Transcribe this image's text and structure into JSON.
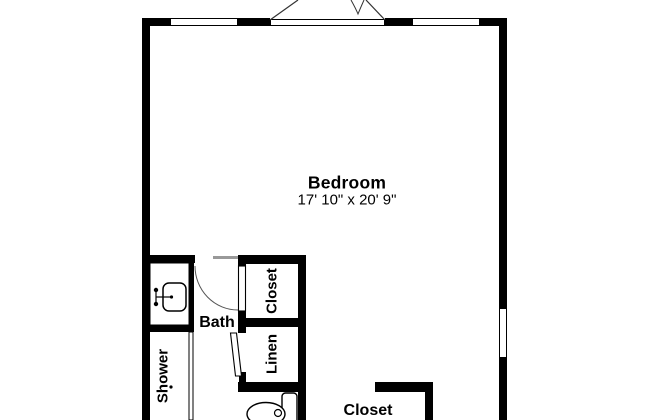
{
  "plan": {
    "type": "floor-plan",
    "rooms": {
      "bedroom": {
        "label": "Bedroom",
        "dimensions": "17' 10\" x 20' 9\""
      },
      "bath": {
        "label": "Bath"
      },
      "shower": {
        "label": "Shower"
      },
      "closet_upper": {
        "label": "Closet"
      },
      "linen": {
        "label": "Linen"
      },
      "closet_lower": {
        "label": "Closet"
      }
    },
    "fixtures": [
      "french-doors",
      "window",
      "window",
      "window-right",
      "vanity-sink",
      "faucet",
      "shower-enclosure",
      "toilet",
      "bath-door-swing",
      "linen-door"
    ],
    "colors": {
      "wall": "#000000",
      "background": "#ffffff",
      "fixture_line": "#333333",
      "door_header": "#999999"
    }
  }
}
